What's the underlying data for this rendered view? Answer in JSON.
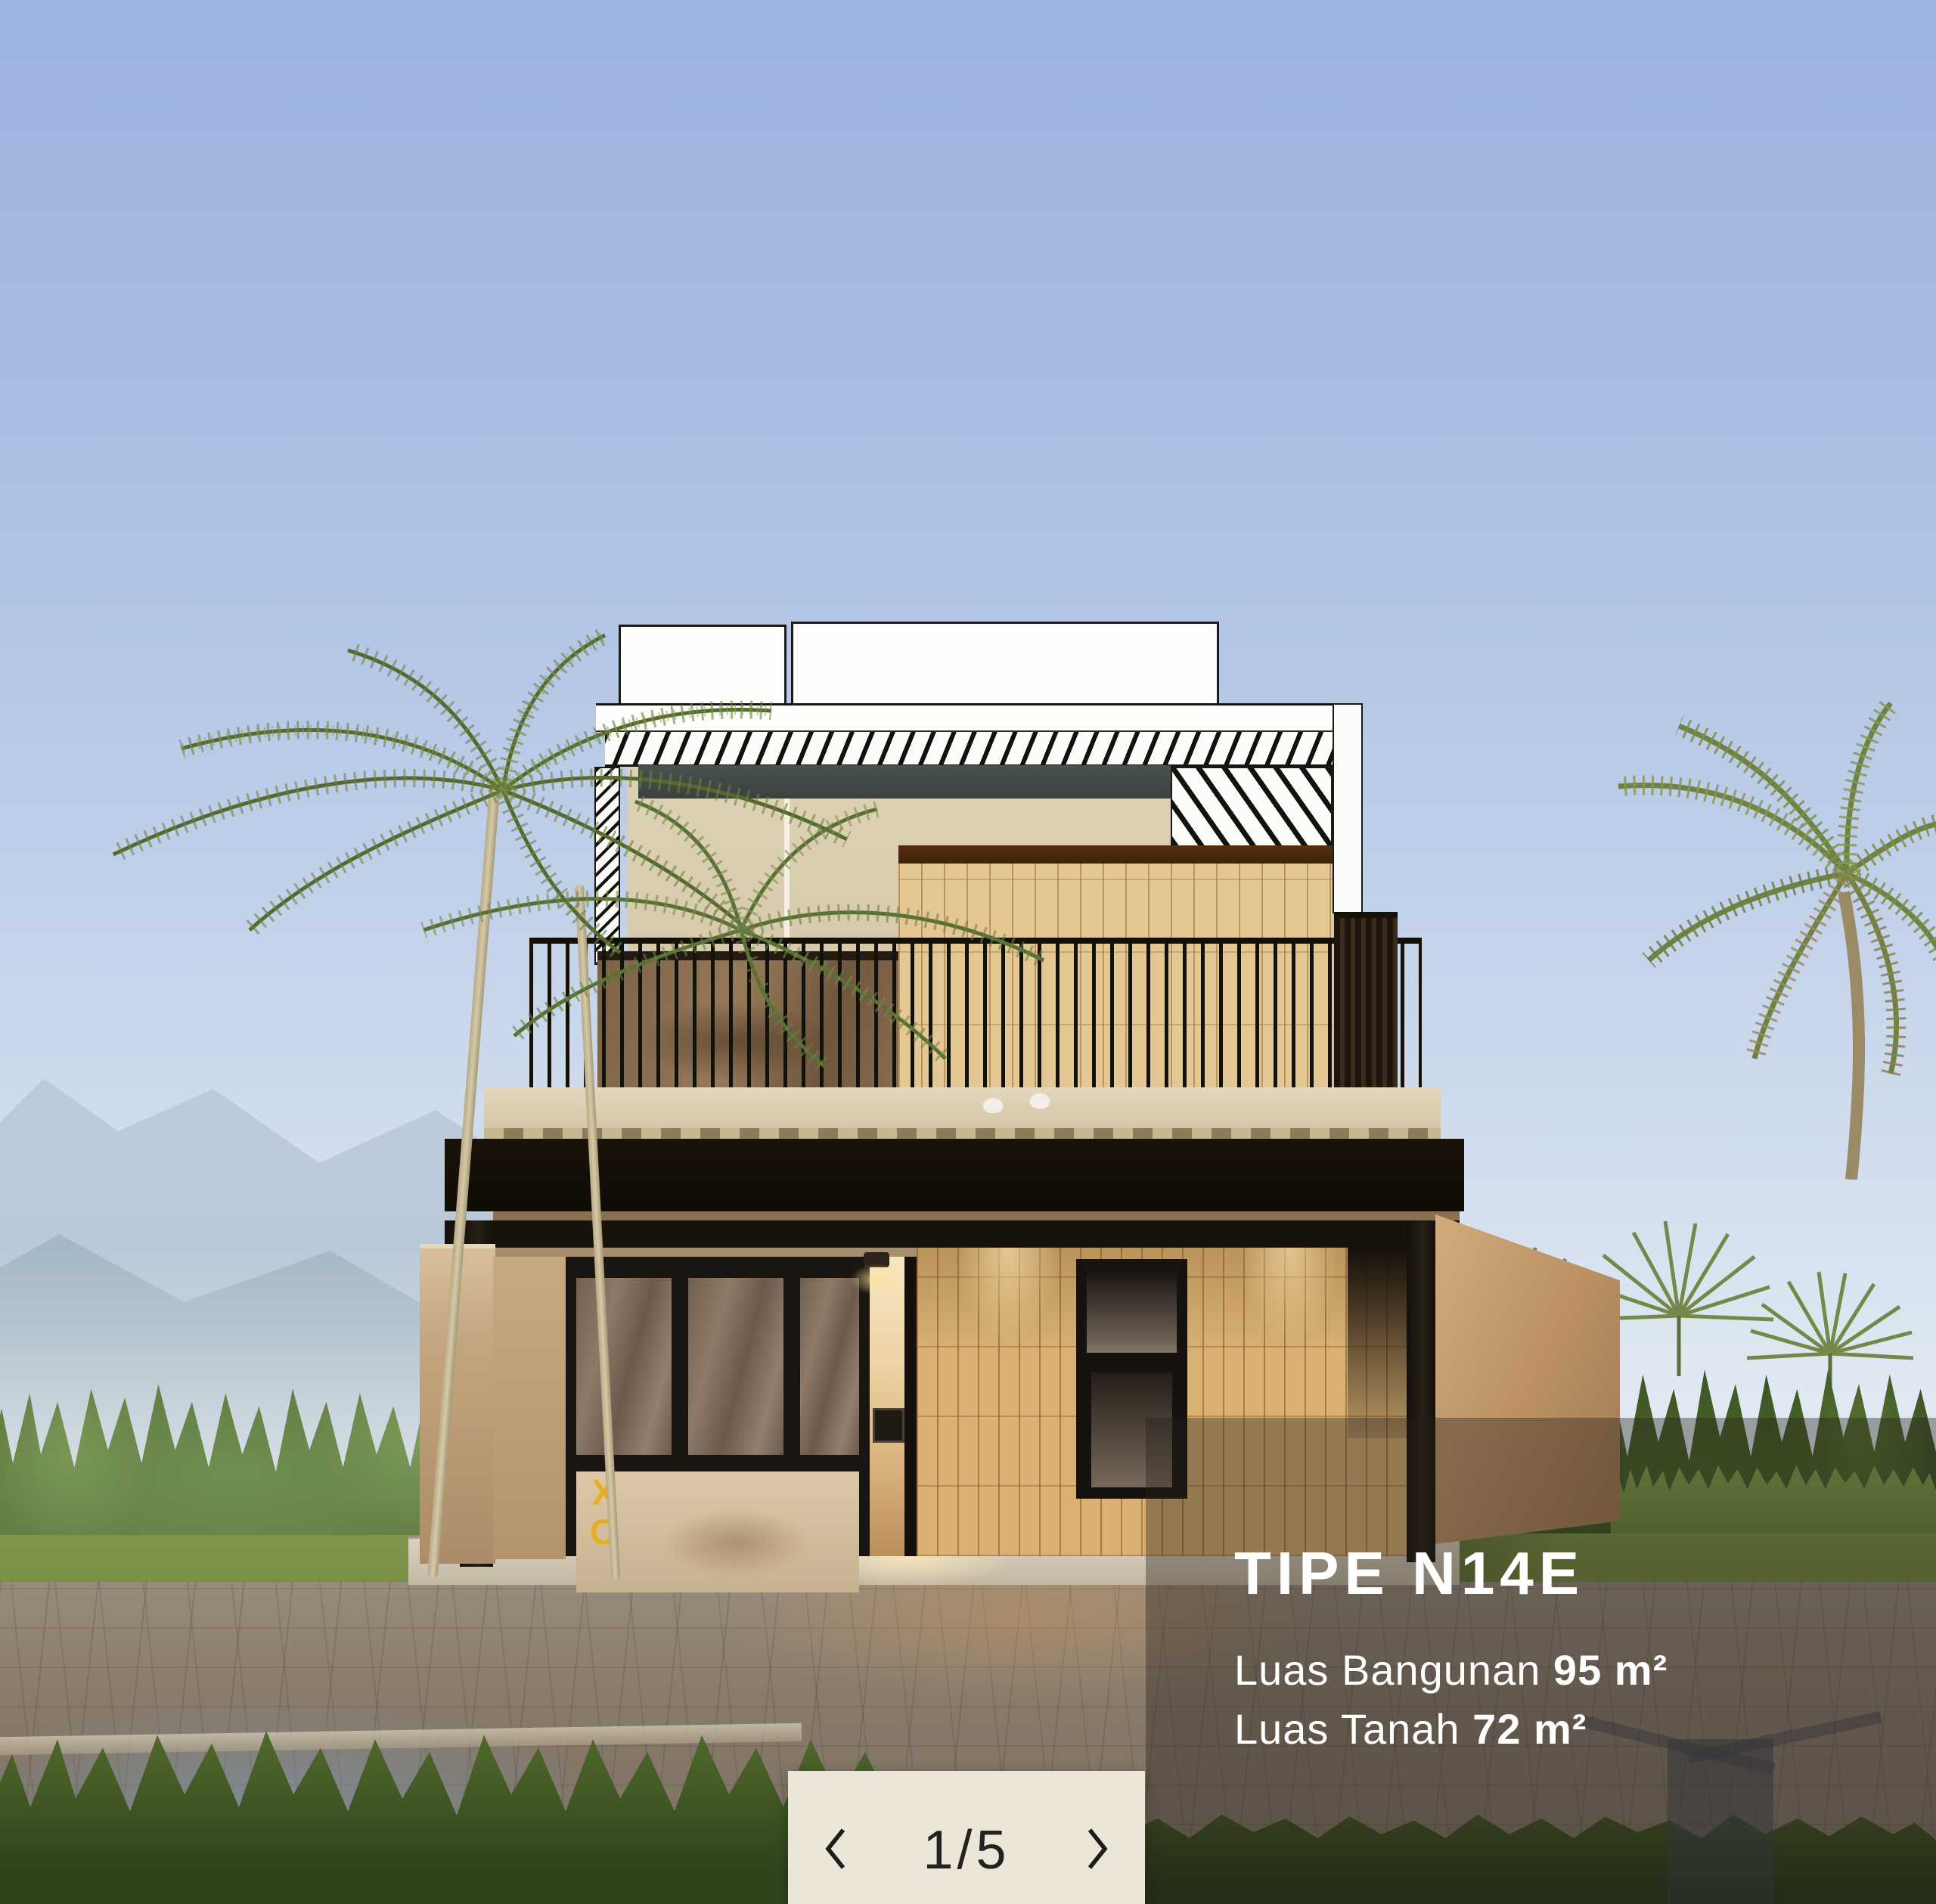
{
  "overlay": {
    "title": "TIPE N14E",
    "specs": [
      {
        "label": "Luas Bangunan ",
        "value": "95 m²"
      },
      {
        "label": "Luas Tanah ",
        "value": "72 m²"
      }
    ]
  },
  "carousel": {
    "page_indicator": "1/5",
    "prev_aria": "Previous image",
    "next_aria": "Next image"
  },
  "scene": {
    "glass_logo": {
      "line1": "X",
      "line2": "O"
    }
  },
  "colors": {
    "overlay_scrim": "rgba(38,32,26,0.38)",
    "pager_bg": "#ece6d9",
    "pager_text": "#232220",
    "logo_yellow": "#e9ad1f",
    "sky_top": "#9db2de",
    "text_white": "#ffffff"
  }
}
